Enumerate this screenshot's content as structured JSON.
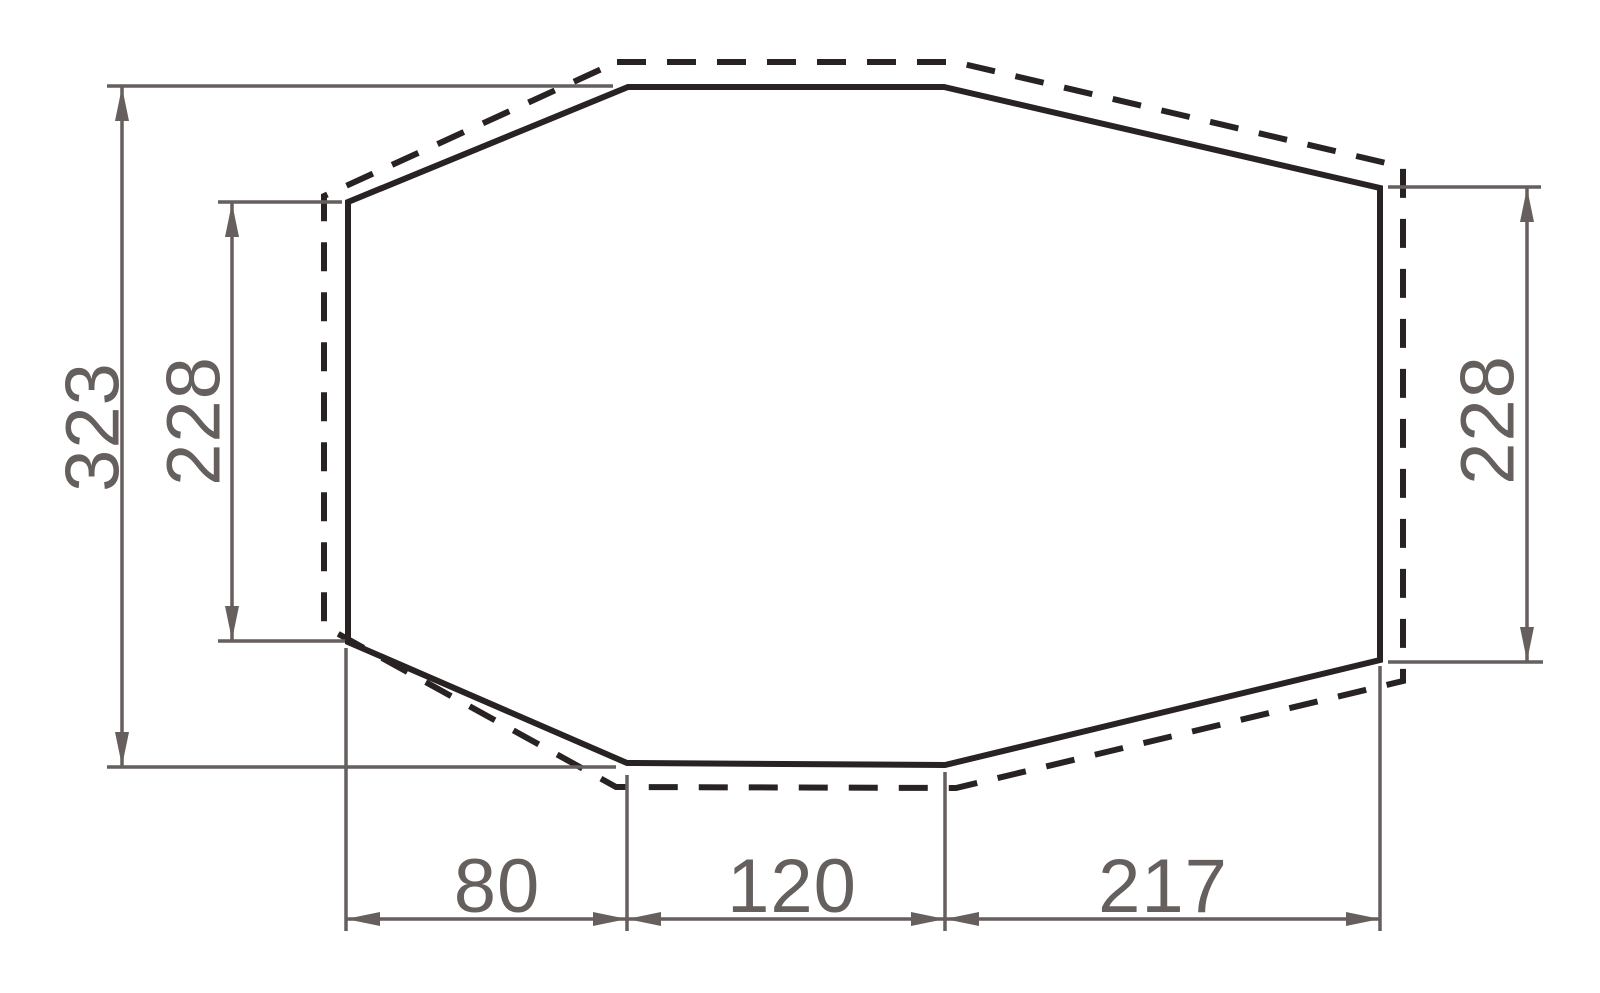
{
  "figure": {
    "kind": "dimensioned-outline-diagram",
    "solid_outline": "inner footprint octagon",
    "dashed_outline": "outer offset octagon"
  },
  "dimensions": {
    "overall_height": "323",
    "left_height": "228",
    "right_height": "228",
    "bottom_left_run": "80",
    "bottom_middle_width": "120",
    "bottom_right_run": "217"
  },
  "colors": {
    "outline": "#282223",
    "dimension": "#655f5d",
    "background": "#ffffff"
  }
}
